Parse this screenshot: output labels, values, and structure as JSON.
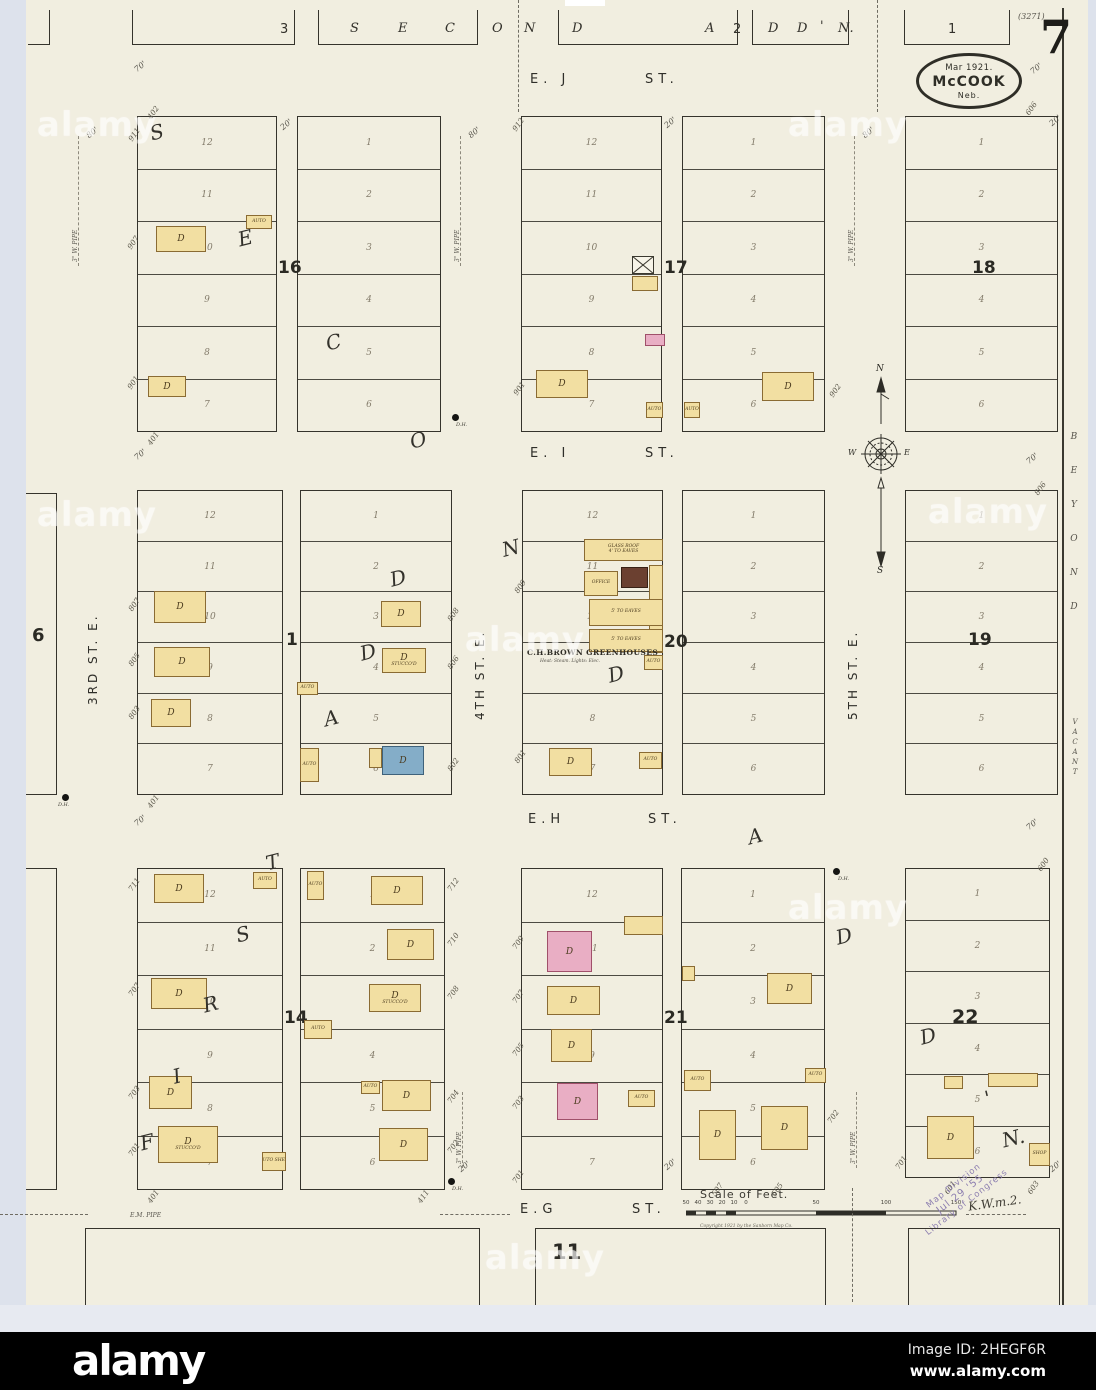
{
  "header": {
    "sheet_number": "7",
    "plate_ref": "(3271)",
    "oval": {
      "line1": "Mar 1921.",
      "line2": "McCOOK",
      "line3": "Neb."
    }
  },
  "top_row": {
    "letters": [
      "3",
      "S",
      "E",
      "C",
      "O",
      "N",
      "D",
      "A",
      "2",
      "D",
      "D",
      "'",
      "N."
    ],
    "block_right": "1"
  },
  "streets": {
    "ej": "E. J",
    "ei": "E. I",
    "eh": "E.H",
    "eg": "E.G",
    "st": "ST.",
    "third": "3RD ST. E.",
    "fourth": "4TH ST. E.",
    "fifth": "5TH ST. E."
  },
  "margins": {
    "beyond": [
      "B",
      "E",
      "Y",
      "O",
      "N",
      "D"
    ],
    "vacant": [
      "V",
      "A",
      "C",
      "A",
      "N",
      "T"
    ]
  },
  "compass": {
    "n": "N",
    "s": "S",
    "w": "W",
    "e": "E"
  },
  "diagonals": {
    "second": [
      "S",
      "E",
      "C",
      "O",
      "N",
      "D",
      "A",
      "D",
      "D",
      "'",
      "N."
    ],
    "first": [
      "F",
      "I",
      "R",
      "S",
      "T",
      "A",
      "D",
      "D"
    ]
  },
  "blocks": {
    "b16": {
      "num": "16",
      "L": [
        "12",
        "11",
        "10",
        "9",
        "8",
        "7"
      ],
      "R": [
        "1",
        "2",
        "3",
        "4",
        "5",
        "6"
      ],
      "tl": "402",
      "bl": "401",
      "e1": "911",
      "e2": "907",
      "e3": "901"
    },
    "b17": {
      "num": "17",
      "L": [
        "12",
        "11",
        "10",
        "9",
        "8",
        "7"
      ],
      "R": [
        "1",
        "2",
        "3",
        "4",
        "5",
        "6"
      ],
      "tl": "912",
      "bl": "901",
      "br": "902"
    },
    "b18": {
      "num": "18",
      "R": [
        "1",
        "2",
        "3",
        "4",
        "5",
        "6"
      ],
      "tr": "606"
    },
    "b6": {
      "num": "6"
    },
    "b1": {
      "num": "1",
      "L": [
        "12",
        "11",
        "10",
        "9",
        "8",
        "7"
      ],
      "R": [
        "1",
        "2",
        "3",
        "4",
        "5",
        "6"
      ],
      "bl": "401",
      "e1": "807",
      "e2": "805",
      "e3": "803",
      "r1": "808",
      "r2": "806",
      "r3": "802"
    },
    "b20": {
      "num": "20",
      "L": [
        "12",
        "11",
        "10",
        "",
        "8",
        "7"
      ],
      "R": [
        "1",
        "2",
        "3",
        "4",
        "5",
        "6"
      ],
      "e1": "809",
      "e2": "801",
      "greenhouse": {
        "name": "C.H.BROWN GREENHOUSES",
        "detail": "Heat: Steam. Lights: Elec.",
        "glass_roof": "GLASS ROOF",
        "eaves4": "4' TO EAVES",
        "eaves5": "5' TO EAVES",
        "office": "OFFICE"
      }
    },
    "b19": {
      "num": "19",
      "R": [
        "1",
        "2",
        "3",
        "4",
        "5",
        "6"
      ],
      "tr": "806"
    },
    "b14": {
      "num": "14",
      "L": [
        "12",
        "11",
        "10",
        "9",
        "8",
        "7"
      ],
      "R": [
        "1",
        "2",
        "3",
        "4",
        "5",
        "6"
      ],
      "bl": "401",
      "br": "411",
      "e1": "711",
      "e2": "707",
      "e3": "703",
      "e4": "701",
      "r1": "712",
      "r2": "710",
      "r3": "708",
      "r4": "704",
      "r5": "702"
    },
    "b21": {
      "num": "21",
      "L": [
        "12",
        "11",
        "10",
        "9",
        "8",
        "7"
      ],
      "R": [
        "1",
        "2",
        "3",
        "4",
        "5",
        "6"
      ],
      "e1": "709",
      "e2": "707",
      "e3": "705",
      "e4": "703",
      "e5": "701",
      "b1": "507",
      "b2": "505",
      "r1": "702"
    },
    "b22": {
      "num": "22",
      "R": [
        "1",
        "2",
        "3",
        "4",
        "5",
        "6"
      ],
      "tr": "600",
      "l1": "701",
      "b1": "601",
      "b2": "603"
    },
    "b11": {
      "num": "11"
    }
  },
  "labels": {
    "d": "D",
    "auto": "AUTO",
    "shop": "SHOP",
    "stuccod": "STUCCO'D",
    "auto_shed": "AUTO SHED",
    "dh": "D.H."
  },
  "annotations": {
    "pipe3": "3\" W. PIPE",
    "pipe_em": "E.M. PIPE",
    "w80": "80'",
    "w70": "70'",
    "w20": "20'"
  },
  "scale": {
    "title": "Scale of Feet.",
    "labels": [
      "50",
      "40",
      "30",
      "20",
      "10",
      "0",
      "50",
      "100",
      "150"
    ],
    "copyright": "Copyright 1921 by the Sanborn Map Co."
  },
  "stamp": {
    "line1": "Map Division",
    "line2": "Jul 29 '55",
    "line3": "Library of Congress",
    "handwriting": "K.W.m.2."
  },
  "watermark": "alamy",
  "footer": {
    "brand": "alamy",
    "image_id": "Image ID: 2HEGF6R",
    "url": "www.alamy.com"
  }
}
